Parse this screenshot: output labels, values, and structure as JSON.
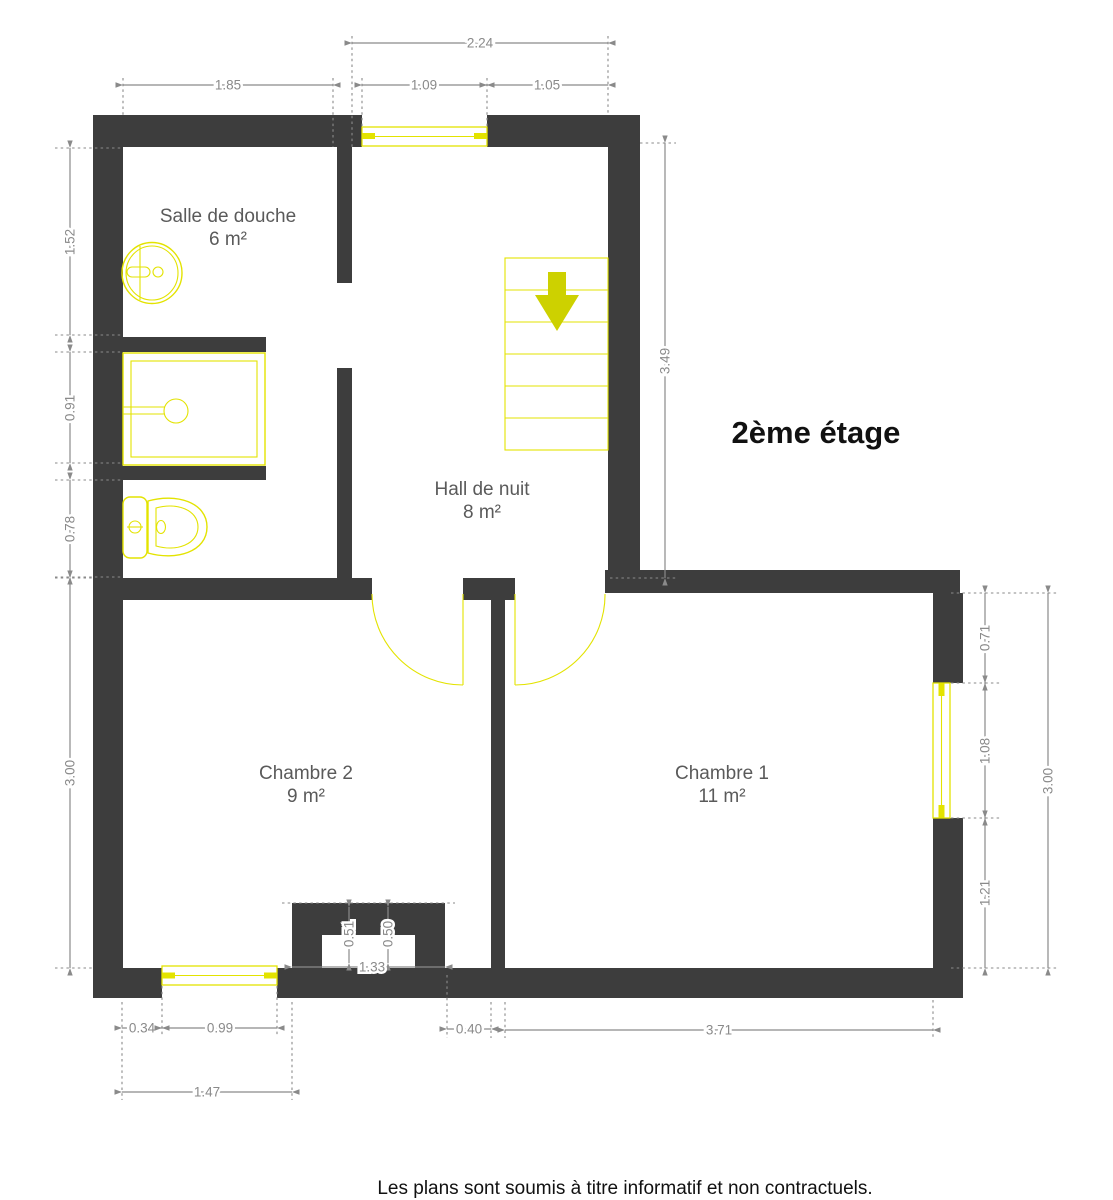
{
  "title": "2ème étage",
  "footer": "Les plans sont soumis à titre informatif et non contractuels.",
  "rooms": [
    {
      "name": "Salle de douche",
      "area": "6 m²"
    },
    {
      "name": "Hall de nuit",
      "area": "8 m²"
    },
    {
      "name": "Chambre 2",
      "area": "9 m²"
    },
    {
      "name": "Chambre 1",
      "area": "11 m²"
    }
  ],
  "dims": {
    "hall_total_width": "2.24",
    "bathroom_width": "1.85",
    "hall_window_width": "1.09",
    "hall_right_width": "1.05",
    "bathroom_sink_section": "1.52",
    "bathroom_shower_section": "0.91",
    "bathroom_wc_section": "0.78",
    "chambre2_depth": "3.00",
    "hall_depth": "3.49",
    "chambre1_wall_above_window": "0.71",
    "chambre1_window_width": "1.08",
    "chambre1_wall_below_window": "1.21",
    "chambre1_depth": "3.00",
    "chambre2_wall_left_of_window": "0.34",
    "chambre2_window_width": "0.99",
    "chambre2_left_total": "1.47",
    "niche_depth_left": "0.51",
    "niche_depth_right": "0.50",
    "niche_width": "1.33",
    "door_offset": "0.40",
    "chambre1_width": "3.71"
  },
  "fixtures": [
    "washbasin",
    "shower-tray",
    "toilet",
    "staircase-down"
  ],
  "colors": {
    "wall": "#3d3d3d",
    "fixture": "#e3e300",
    "stairs_arrow": "#cdd100",
    "dim": "#8a8a8a",
    "label": "#5a5a5a",
    "title": "#111111"
  }
}
